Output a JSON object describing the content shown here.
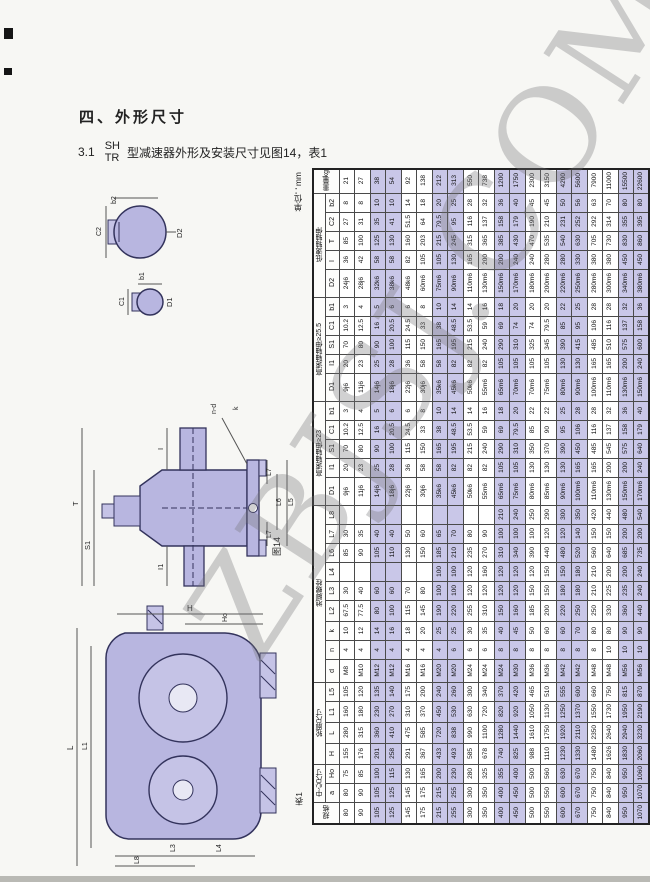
{
  "page": {
    "unit_label": "单位：mm",
    "table_caption": "表1",
    "watermark": "ZBJSJ.COM"
  },
  "heading": {
    "section": "四、外形尺寸",
    "item_no": "3.1",
    "model_top": "SH",
    "model_bottom": "TR",
    "text": "型减速器外形及安装尺寸见图14，表1"
  },
  "figures": {
    "sections": {
      "d2": "D2",
      "b2": "b2",
      "c2": "C2",
      "d1": "D1",
      "b1": "b1",
      "c1": "C1"
    },
    "side": {
      "t": "T",
      "i": "I",
      "s1": "S1",
      "i1": "I1",
      "k": "k",
      "nd": "n-d",
      "l7t": "L7",
      "l6": "L6",
      "l5": "L5",
      "l7b": "L7",
      "caption": "图14"
    },
    "front": {
      "h": "H",
      "ho": "Ho",
      "l": "L",
      "l1": "L1",
      "l3": "L3",
      "l4": "L4",
      "l8": "L8"
    }
  },
  "table": {
    "sizes": [
      "80",
      "90",
      "105",
      "125",
      "145",
      "175",
      "215",
      "255",
      "300",
      "350",
      "400",
      "450",
      "500",
      "550",
      "600",
      "670",
      "750",
      "840",
      "950",
      "1070"
    ],
    "rows": [
      {
        "span2": true,
        "label": "重量kg",
        "h": "h21",
        "values": [
          "21",
          "27",
          "38",
          "54",
          "92",
          "138",
          "212",
          "313",
          "550",
          "738",
          "1200",
          "1750",
          "2300",
          "3150",
          "4200",
          "5600",
          "7900",
          "11000",
          "15500",
          "22600"
        ]
      },
      {
        "g": "低速轴轴伸",
        "gspan": 5,
        "label": "b2",
        "h": "h19",
        "values": [
          "8",
          "8",
          "10",
          "10",
          "14",
          "18",
          "20",
          "25",
          "28",
          "32",
          "36",
          "40",
          "45",
          "45",
          "50",
          "56",
          "63",
          "70",
          "80",
          "80"
        ]
      },
      {
        "label": "C2",
        "h": "h19",
        "values": [
          "27",
          "31",
          "35",
          "41",
          "51.5",
          "64",
          "79.5",
          "95",
          "116",
          "137",
          "158",
          "179",
          "190",
          "210",
          "231",
          "252",
          "292",
          "314",
          "355",
          "395"
        ]
      },
      {
        "label": "T",
        "h": "h19",
        "values": [
          "85",
          "100",
          "125",
          "130",
          "160",
          "203",
          "215",
          "245",
          "315",
          "365",
          "385",
          "430",
          "470",
          "535",
          "540",
          "630",
          "705",
          "730",
          "830",
          "860"
        ]
      },
      {
        "label": "I",
        "h": "h19",
        "values": [
          "36",
          "42",
          "58",
          "58",
          "82",
          "105",
          "105",
          "130",
          "165",
          "200",
          "200",
          "240",
          "240",
          "280",
          "280",
          "330",
          "380",
          "380",
          "450",
          "450"
        ]
      },
      {
        "label": "D2",
        "h": "h28",
        "values": [
          "24j6",
          "28j6",
          "32k6",
          "38k6",
          "48k6",
          "60m6",
          "75m6",
          "90m6",
          "110m6",
          "130m6",
          "150m6",
          "170m6",
          "180m6",
          "200m6",
          "220m6",
          "250m6",
          "280m6",
          "300m6",
          "340m6",
          "380m6"
        ]
      },
      {
        "g": "高速轴轴伸≥25.5",
        "gspan": 5,
        "label": "b1",
        "h": "h19",
        "values": [
          "3",
          "4",
          "5",
          "6",
          "6",
          "8",
          "10",
          "14",
          "14",
          "16",
          "18",
          "20",
          "20",
          "20",
          "22",
          "25",
          "28",
          "28",
          "32",
          "36"
        ]
      },
      {
        "label": "C1",
        "h": "h19",
        "values": [
          "10.2",
          "12.5",
          "16",
          "20.5",
          "24.5",
          "33",
          "38",
          "48.5",
          "53.5",
          "59",
          "69",
          "74",
          "74",
          "79.5",
          "85",
          "95",
          "106",
          "116",
          "137",
          "158"
        ]
      },
      {
        "label": "S1",
        "h": "h19",
        "values": [
          "70",
          "80",
          "90",
          "100",
          "115",
          "150",
          "165",
          "195",
          "215",
          "240",
          "290",
          "310",
          "325",
          "345",
          "390",
          "415",
          "485",
          "510",
          "575",
          "600"
        ]
      },
      {
        "label": "I1",
        "h": "h19",
        "values": [
          "20",
          "23",
          "25",
          "28",
          "36",
          "58",
          "58",
          "82",
          "82",
          "82",
          "105",
          "105",
          "105",
          "105",
          "130",
          "130",
          "165",
          "165",
          "200",
          "240"
        ]
      },
      {
        "label": "D1",
        "h": "h28",
        "values": [
          "9j6",
          "11j6",
          "14j6",
          "18j6",
          "22j6",
          "30j6",
          "35k6",
          "45k6",
          "50k6",
          "55m6",
          "65m6",
          "70m6",
          "70m6",
          "75m6",
          "80m6",
          "90m6",
          "100m6",
          "110m6",
          "130m6",
          "150m6"
        ]
      },
      {
        "g": "高速轴轴伸≥23",
        "gspan": 5,
        "label": "b1",
        "h": "h19",
        "values": [
          "3",
          "4",
          "5",
          "6",
          "6",
          "8",
          "10",
          "14",
          "14",
          "16",
          "18",
          "20",
          "22",
          "22",
          "25",
          "28",
          "28",
          "32",
          "36",
          "40"
        ]
      },
      {
        "label": "C1",
        "h": "h19",
        "values": [
          "10.2",
          "12.5",
          "16",
          "20.5",
          "24.5",
          "33",
          "38",
          "48.5",
          "53.5",
          "59",
          "69",
          "79.5",
          "85",
          "90",
          "95",
          "106",
          "116",
          "137",
          "158",
          "179"
        ]
      },
      {
        "label": "S1",
        "h": "h19",
        "values": [
          "70",
          "80",
          "90",
          "100",
          "115",
          "150",
          "165",
          "195",
          "215",
          "240",
          "290",
          "310",
          "350",
          "370",
          "390",
          "450",
          "485",
          "545",
          "575",
          "640"
        ]
      },
      {
        "label": "I1",
        "h": "h19",
        "values": [
          "20",
          "23",
          "25",
          "28",
          "36",
          "58",
          "58",
          "82",
          "82",
          "82",
          "105",
          "105",
          "130",
          "130",
          "130",
          "165",
          "165",
          "200",
          "200",
          "240"
        ]
      },
      {
        "label": "D1",
        "h": "h28",
        "values": [
          "9j6",
          "11j6",
          "14j6",
          "18j6",
          "22j6",
          "30j6",
          "35k6",
          "45k6",
          "50k6",
          "55m6",
          "65m6",
          "75m6",
          "80m6",
          "85m6",
          "90m6",
          "100m6",
          "110m6",
          "130m6",
          "150m6",
          "170m6"
        ]
      },
      {
        "g": "地脚螺栓",
        "gspan": 9,
        "label": "L8",
        "h": "h19",
        "values": [
          "",
          "",
          "",
          "",
          "",
          "",
          "",
          "",
          "",
          "",
          "210",
          "240",
          "250",
          "290",
          "300",
          "350",
          "420",
          "440",
          "480",
          "540"
        ]
      },
      {
        "label": "L7",
        "h": "h19",
        "values": [
          "30",
          "35",
          "40",
          "40",
          "50",
          "60",
          "65",
          "70",
          "80",
          "90",
          "100",
          "100",
          "100",
          "120",
          "120",
          "140",
          "150",
          "150",
          "200",
          "200"
        ]
      },
      {
        "label": "L6",
        "h": "h19",
        "values": [
          "85",
          "90",
          "105",
          "110",
          "130",
          "150",
          "185",
          "210",
          "235",
          "270",
          "310",
          "340",
          "390",
          "440",
          "480",
          "520",
          "560",
          "640",
          "685",
          "735"
        ]
      },
      {
        "label": "L4",
        "h": "h19",
        "values": [
          "",
          "",
          "",
          "",
          "",
          "",
          "100",
          "100",
          "120",
          "160",
          "120",
          "120",
          "120",
          "150",
          "150",
          "180",
          "210",
          "200",
          "200",
          "240"
        ]
      },
      {
        "label": "L3",
        "h": "h19",
        "values": [
          "30",
          "40",
          "60",
          "60",
          "70",
          "80",
          "100",
          "100",
          "120",
          "120",
          "120",
          "120",
          "150",
          "150",
          "180",
          "180",
          "210",
          "225",
          "235",
          "240"
        ]
      },
      {
        "label": "L2",
        "h": "h21",
        "values": [
          "67.5",
          "77.5",
          "80",
          "100",
          "115",
          "145",
          "190",
          "220",
          "255",
          "310",
          "150",
          "160",
          "185",
          "200",
          "220",
          "250",
          "250",
          "330",
          "360",
          "440"
        ]
      },
      {
        "label": "k",
        "h": "h19",
        "values": [
          "10",
          "12",
          "14",
          "16",
          "18",
          "20",
          "25",
          "25",
          "30",
          "35",
          "40",
          "45",
          "50",
          "60",
          "60",
          "70",
          "80",
          "80",
          "90",
          "90"
        ]
      },
      {
        "label": "n",
        "h": "h19",
        "values": [
          "4",
          "4",
          "4",
          "4",
          "4",
          "4",
          "4",
          "6",
          "6",
          "6",
          "8",
          "8",
          "8",
          "8",
          "8",
          "8",
          "8",
          "10",
          "10",
          "10"
        ]
      },
      {
        "label": "d",
        "h": "h23",
        "values": [
          "M8",
          "M10",
          "M12",
          "M12",
          "M16",
          "M16",
          "M20",
          "M20",
          "M24",
          "M24",
          "M24",
          "M30",
          "M36",
          "M36",
          "M42",
          "M42",
          "M48",
          "M48",
          "M56",
          "M56"
        ]
      },
      {
        "g": "轮廓尺寸",
        "gspan": 4,
        "label": "L5",
        "h": "h19",
        "values": [
          "105",
          "120",
          "135",
          "140",
          "175",
          "200",
          "240",
          "260",
          "300",
          "340",
          "370",
          "420",
          "465",
          "510",
          "555",
          "600",
          "660",
          "750",
          "815",
          "870"
        ]
      },
      {
        "label": "L1",
        "h": "h21",
        "values": [
          "160",
          "180",
          "230",
          "270",
          "310",
          "370",
          "450",
          "530",
          "630",
          "720",
          "820",
          "920",
          "1050",
          "1130",
          "1250",
          "1370",
          "1550",
          "1730",
          "1950",
          "2190"
        ]
      },
      {
        "label": "L",
        "h": "h21",
        "values": [
          "280",
          "315",
          "360",
          "410",
          "475",
          "585",
          "720",
          "838",
          "990",
          "1100",
          "1280",
          "1440",
          "1610",
          "1750",
          "1920",
          "2110",
          "2350",
          "2640",
          "2940",
          "3230"
        ]
      },
      {
        "label": "H",
        "h": "h21",
        "values": [
          "155",
          "176",
          "201",
          "258",
          "291",
          "367",
          "433",
          "493",
          "585",
          "678",
          "740",
          "825",
          "988",
          "1110",
          "1230",
          "1330",
          "1480",
          "1626",
          "1830",
          "2060"
        ]
      },
      {
        "g": "中心尺寸",
        "gspan": 2,
        "label": "Ho",
        "h": "h19",
        "values": [
          "75",
          "85",
          "100",
          "115",
          "130",
          "165",
          "200",
          "230",
          "280",
          "325",
          "355",
          "400",
          "500",
          "560",
          "630",
          "670",
          "750",
          "840",
          "950",
          "1060"
        ]
      },
      {
        "label": "a",
        "h": "h19",
        "values": [
          "80",
          "90",
          "105",
          "125",
          "145",
          "175",
          "215",
          "255",
          "300",
          "350",
          "400",
          "450",
          "500",
          "550",
          "600",
          "670",
          "750",
          "840",
          "950",
          "1070"
        ]
      },
      {
        "span2": true,
        "label": "规格",
        "h": "h21",
        "values": [
          "80",
          "90",
          "105",
          "125",
          "145",
          "175",
          "215",
          "255",
          "300",
          "350",
          "400",
          "450",
          "500",
          "550",
          "600",
          "670",
          "750",
          "840",
          "950",
          "1070"
        ]
      }
    ]
  }
}
